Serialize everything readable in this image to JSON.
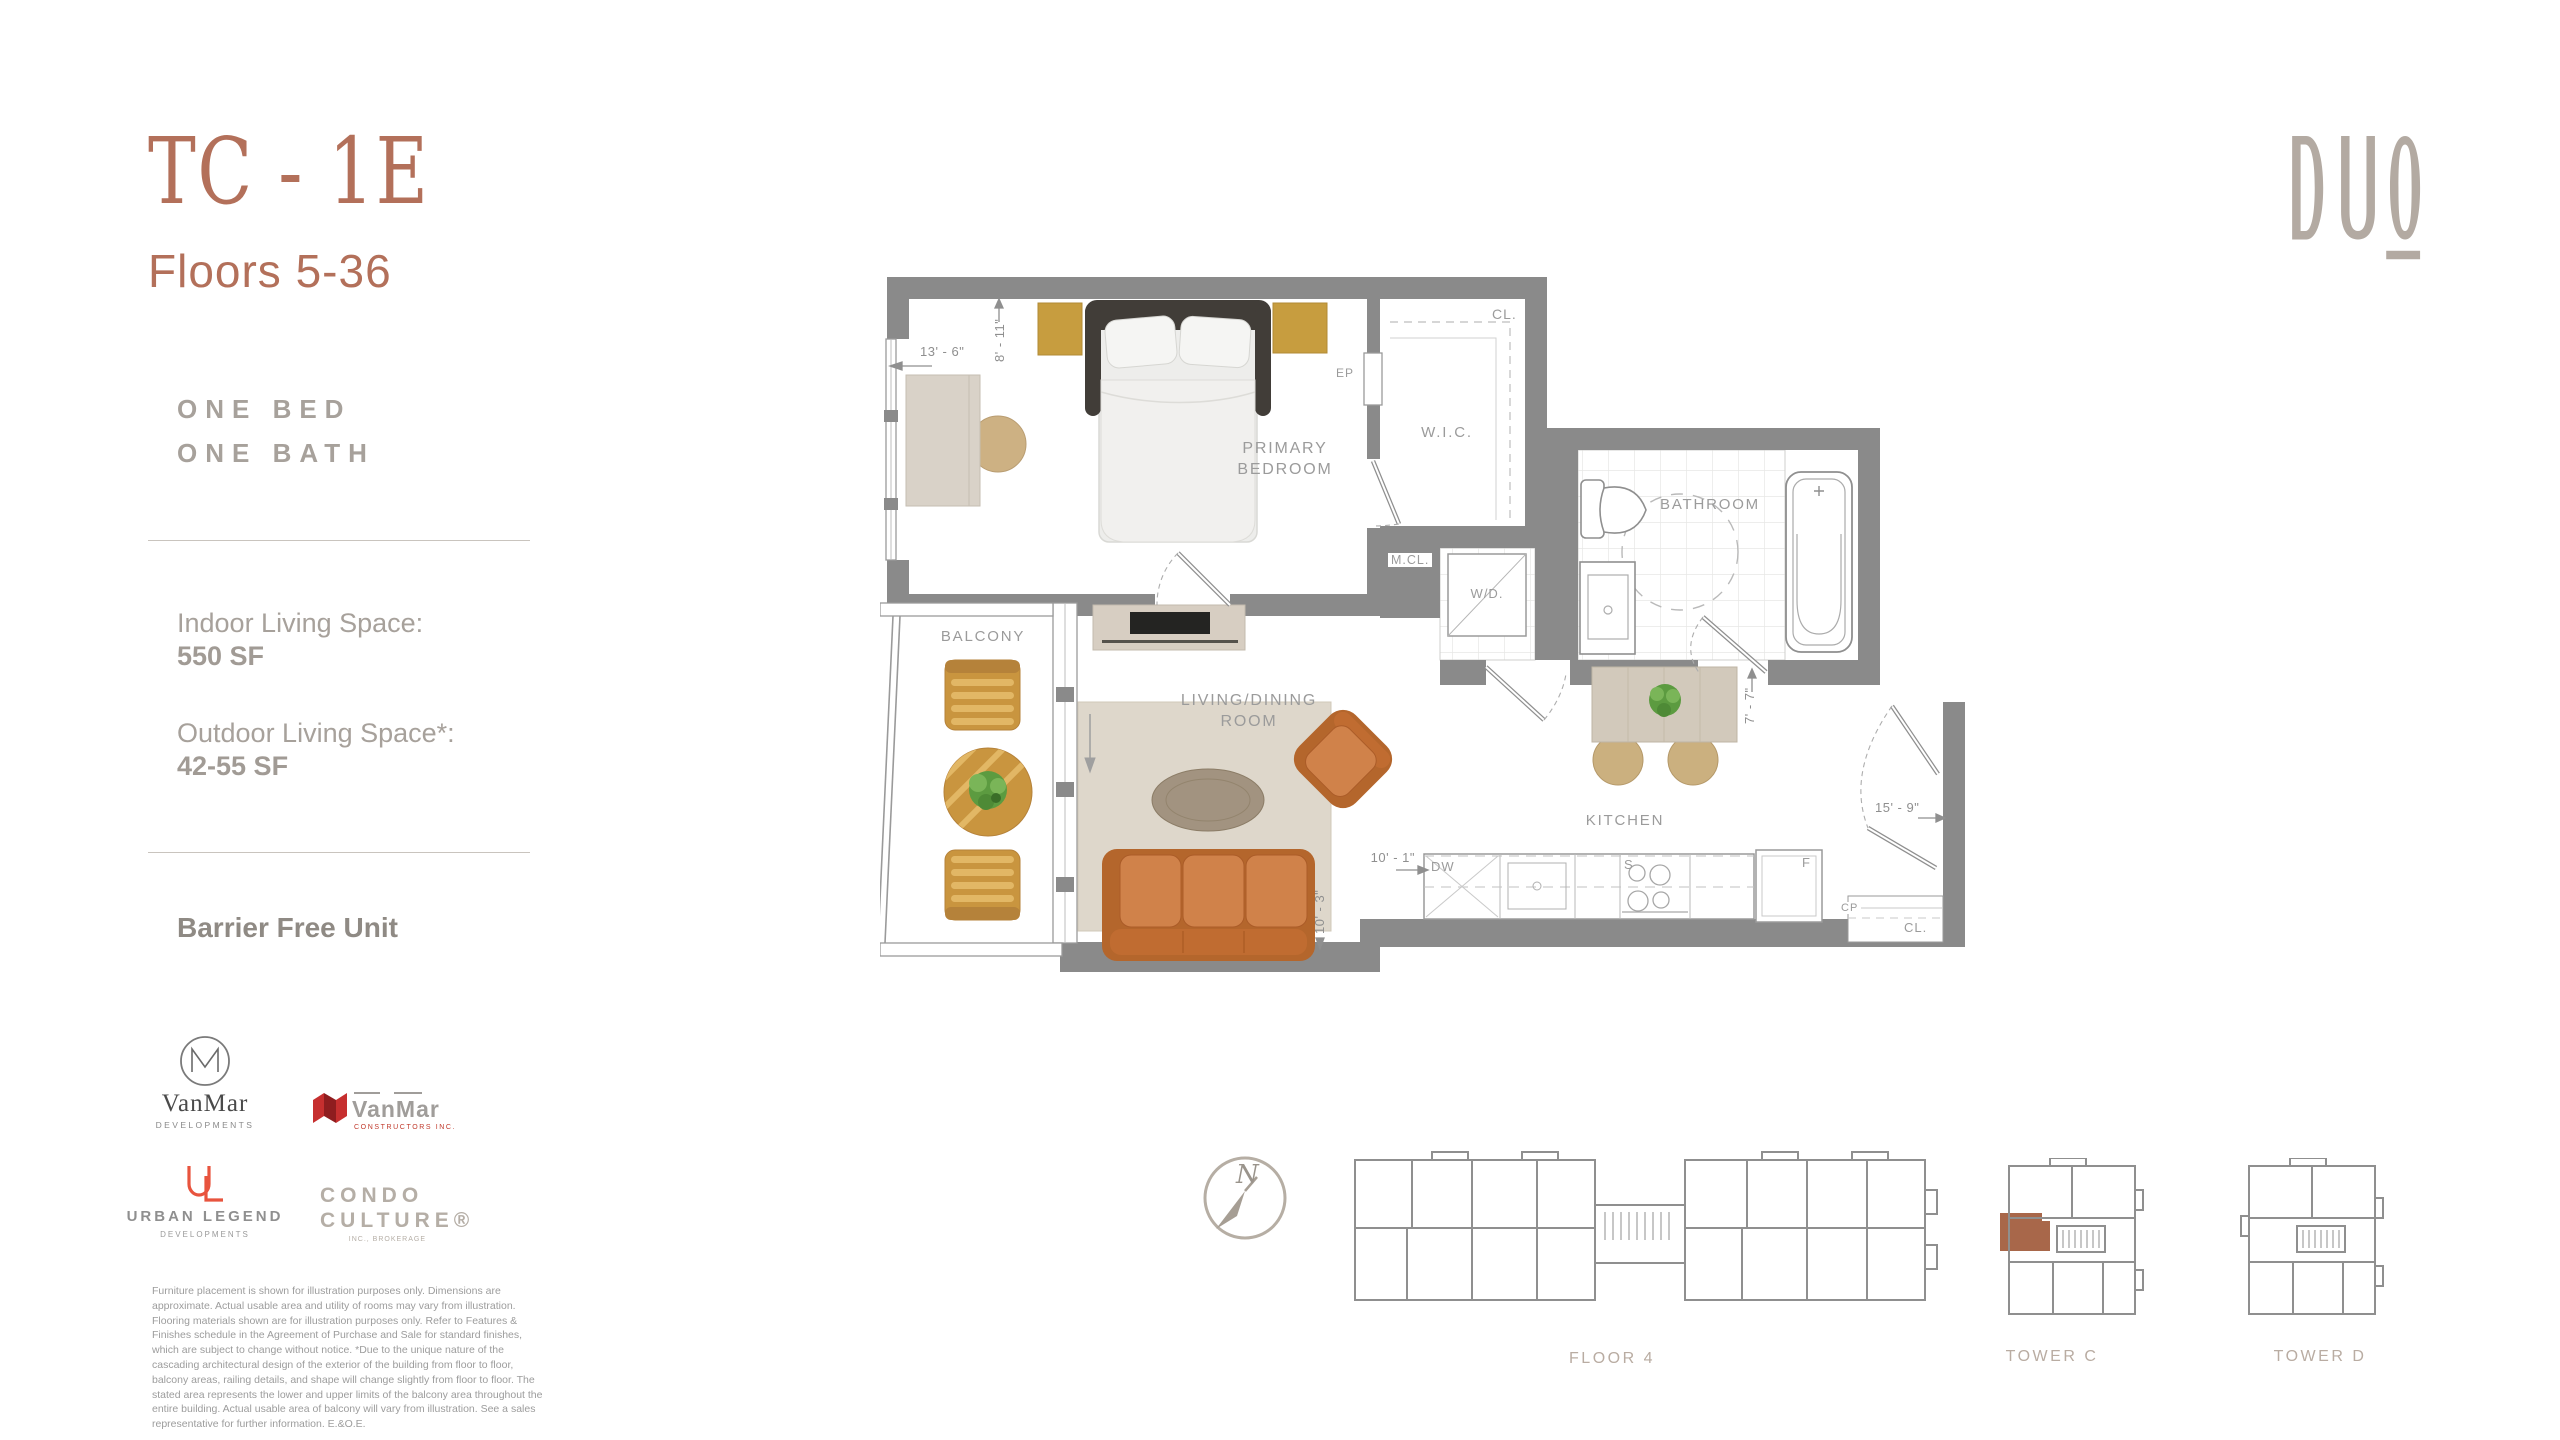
{
  "sidebar": {
    "unit_code": "TC - 1E",
    "floors_range": "Floors 5-36",
    "bed_line": "ONE BED",
    "bath_line": "ONE BATH",
    "indoor_label": "Indoor Living Space:",
    "indoor_value": "550 SF",
    "outdoor_label": "Outdoor Living Space*:",
    "outdoor_value": "42-55 SF",
    "barrier_free": "Barrier Free Unit",
    "disclaimer": "Furniture placement is shown for illustration purposes only. Dimensions are approximate. Actual usable area and utility of rooms may vary from illustration. Flooring materials shown are for illustration purposes only. Refer to Features & Finishes schedule in the Agreement of Purchase and Sale for standard finishes, which are subject to change without notice. *Due to the unique nature of the cascading architectural design of the exterior of the building from floor to floor, balcony areas, railing details, and shape will change slightly from floor to floor. The stated area represents the lower and upper limits of the balcony area throughout the entire building. Actual usable area of balcony will vary from illustration. See a sales representative for further information. E.&O.E."
  },
  "partners": {
    "vanmar_dev_name": "VanMar",
    "vanmar_dev_sub": "DEVELOPMENTS",
    "vanmar_con_name": "VanMar",
    "vanmar_con_sub": "CONSTRUCTORS INC.",
    "urban_legend_name": "URBAN LEGEND",
    "urban_legend_sub": "DEVELOPMENTS",
    "condo_line1": "CONDO",
    "condo_line2": "CULTURE®",
    "condo_sub": "INC., BROKERAGE"
  },
  "brand": {
    "logo_text": "DUO"
  },
  "plan": {
    "rooms": {
      "primary_bedroom": "PRIMARY\nBEDROOM",
      "wic": "W.I.C.",
      "bathroom": "BATHROOM",
      "balcony": "BALCONY",
      "living_dining": "LIVING/DINING\nROOM",
      "kitchen": "KITCHEN"
    },
    "fixtures": {
      "closet_top": "CL.",
      "ep": "EP",
      "mcl": "M.CL.",
      "wd": "W/D.",
      "dw": "DW",
      "stove": "S",
      "fridge": "F",
      "cp": "CP",
      "closet_entry": "CL."
    },
    "dimensions": {
      "bedroom_width": "13' - 6\"",
      "bedroom_depth": "8' - 11\"",
      "bath_depth": "7' - 7\"",
      "living_width": "10' - 1\"",
      "living_depth": "10' - 3\"",
      "kitchen_width": "15' - 9\""
    },
    "colors": {
      "wall": "#8a8a8a",
      "accent": "#a8674a"
    }
  },
  "keyplans": {
    "compass_n": "N",
    "floor_label": "FLOOR 4",
    "tower_c_label": "TOWER C",
    "tower_d_label": "TOWER D"
  }
}
